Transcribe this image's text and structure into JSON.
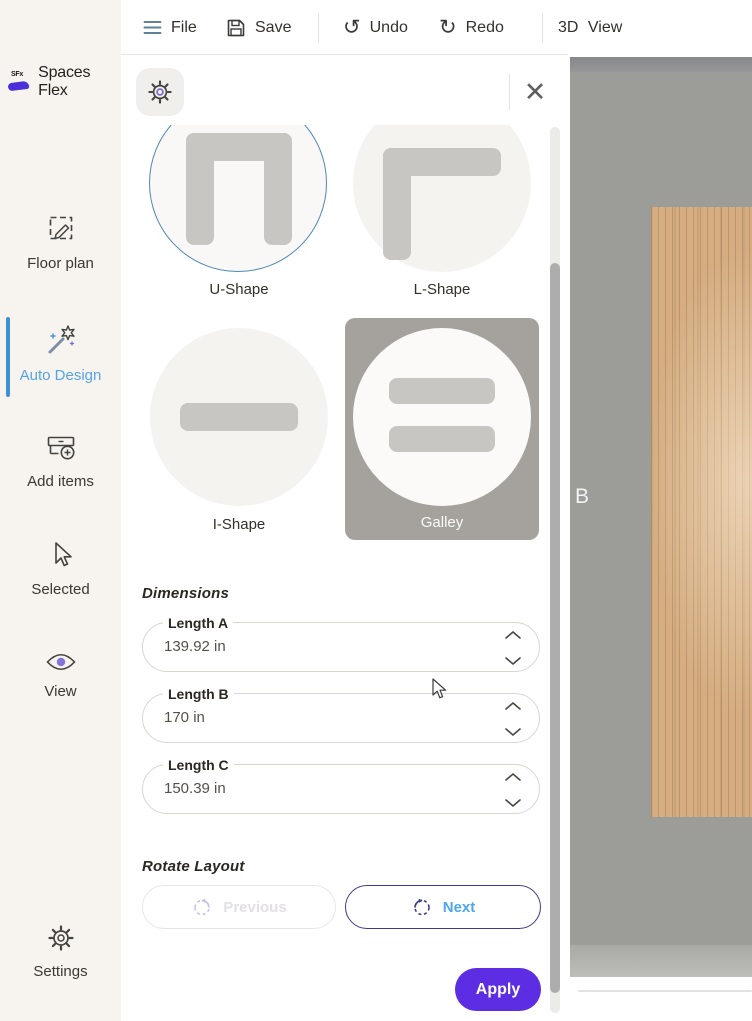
{
  "brand": {
    "badge": "SFx",
    "name": "Spaces Flex"
  },
  "toolbar": {
    "file": "File",
    "save": "Save",
    "undo": "Undo",
    "redo": "Redo",
    "view_3d": "3D View"
  },
  "sidebar": {
    "items": [
      {
        "label": "Floor plan"
      },
      {
        "label": "Auto Design",
        "state": "active"
      },
      {
        "label": "Add items"
      },
      {
        "label": "Selected"
      },
      {
        "label": "View"
      },
      {
        "label": "Settings"
      }
    ]
  },
  "panel": {
    "shapes": [
      {
        "label": "U-Shape",
        "state": "selected"
      },
      {
        "label": "L-Shape",
        "state": "default"
      },
      {
        "label": "I-Shape",
        "state": "default"
      },
      {
        "label": "Galley",
        "state": "highlighted"
      }
    ],
    "dimensions": {
      "heading": "Dimensions",
      "fields": [
        {
          "label": "Length A",
          "value": "139.92 in"
        },
        {
          "label": "Length B",
          "value": "170 in"
        },
        {
          "label": "Length C",
          "value": "150.39 in"
        }
      ]
    },
    "rotate": {
      "heading": "Rotate Layout",
      "previous_label": "Previous",
      "next_label": "Next"
    },
    "apply_label": "Apply",
    "close_glyph": "✕"
  },
  "canvas": {
    "wall_label": "B"
  },
  "colors": {
    "accent_purple": "#5C2DE3",
    "accent_blue": "#4EA7E8",
    "selected_ring": "#4E87B8",
    "active_nav": "#56A3E8",
    "brand_purple": "#4B2FD8",
    "sidebar_bg": "#F7F4F0",
    "galley_card_bg": "#A5A29E",
    "wood": "#D5AD81"
  }
}
